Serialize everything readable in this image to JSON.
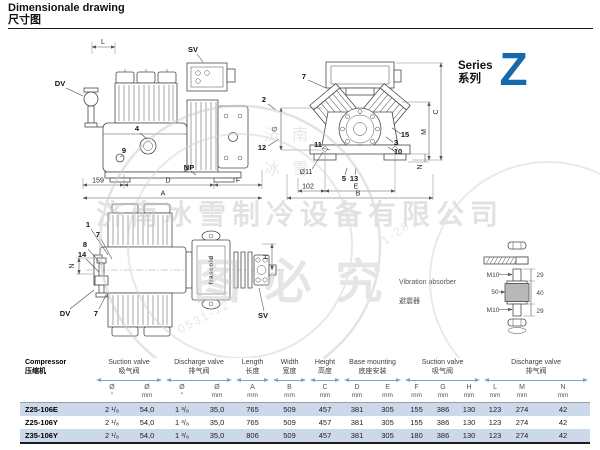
{
  "header": {
    "title_en": "Dimensionale drawing",
    "title_zh": "尺寸图"
  },
  "series": {
    "label_en": "Series",
    "label_zh": "系列",
    "letter": "Z",
    "color": "#1569ac"
  },
  "watermark": {
    "company": "济南冰雪制冷设备有限公司",
    "stamp": "图必究",
    "chars_1": "济",
    "chars_2": "南",
    "chars_3": "冰",
    "chars_4": "雪",
    "arc_left": "0531-12",
    "arc_right": "1-28"
  },
  "side_view": {
    "dim_l": "L",
    "sv": "SV",
    "dv": "DV",
    "c4": "4",
    "c9": "9",
    "np": "NP",
    "dim_159": "159",
    "dim_d": "D",
    "dim_f": "F",
    "dim_a": "A"
  },
  "front_view": {
    "c7": "7",
    "c2": "2",
    "c12": "12",
    "dim_g": "G",
    "c11": "11",
    "c15": "15",
    "c3": "3",
    "c10": "10",
    "c5": "5",
    "c13": "13",
    "dia11": "Ø11",
    "dim_102": "102",
    "dim_e": "E",
    "dim_b": "B",
    "dim_m": "M",
    "dim_c": "C",
    "dim_n": "N"
  },
  "top_view": {
    "c1": "1",
    "c7a": "7",
    "c8": "8",
    "c14": "14",
    "dim_n": "N",
    "dv": "DV",
    "c7b": "7",
    "sv": "SV",
    "dim_h": "H",
    "brand": "frascold"
  },
  "absorber": {
    "label_en": "Vibration absorber",
    "label_zh": "避震器",
    "m10_top": "M10",
    "m10_bot": "M10",
    "d50": "50",
    "d29_top": "29",
    "d40": "40",
    "d29_bot": "29"
  },
  "table": {
    "groups": [
      {
        "en": "Compressor",
        "zh": "压缩机"
      },
      {
        "en": "Suction valve",
        "zh": "吸气阀"
      },
      {
        "en": "Discharge valve",
        "zh": "排气阀"
      },
      {
        "en": "Length",
        "zh": "长度"
      },
      {
        "en": "Width",
        "zh": "宽度"
      },
      {
        "en": "Height",
        "zh": "高度"
      },
      {
        "en": "Base mounting",
        "zh": "底座安装"
      },
      {
        "en": "Suction valve",
        "zh": "吸气阀"
      },
      {
        "en": "Discharge valve",
        "zh": "排气阀"
      }
    ],
    "cols": [
      {
        "sym": "Ø",
        "unit": "″"
      },
      {
        "sym": "Ø",
        "unit": "mm"
      },
      {
        "sym": "Ø",
        "unit": "″"
      },
      {
        "sym": "Ø",
        "unit": "mm"
      },
      {
        "sym": "A",
        "unit": "mm"
      },
      {
        "sym": "B",
        "unit": "mm"
      },
      {
        "sym": "C",
        "unit": "mm"
      },
      {
        "sym": "D",
        "unit": "mm"
      },
      {
        "sym": "E",
        "unit": "mm"
      },
      {
        "sym": "F",
        "unit": "mm"
      },
      {
        "sym": "G",
        "unit": "mm"
      },
      {
        "sym": "H",
        "unit": "mm"
      },
      {
        "sym": "L",
        "unit": "mm"
      },
      {
        "sym": "M",
        "unit": "mm"
      },
      {
        "sym": "N",
        "unit": "mm"
      }
    ],
    "rows": [
      {
        "model": "Z25-106E",
        "values": [
          "2 ¹/₈",
          "54,0",
          "1 ³/₈",
          "35,0",
          "765",
          "509",
          "457",
          "381",
          "305",
          "155",
          "386",
          "130",
          "123",
          "274",
          "42"
        ]
      },
      {
        "model": "Z25-106Y",
        "values": [
          "2 ¹/₈",
          "54,0",
          "1 ³/₈",
          "35,0",
          "765",
          "509",
          "457",
          "381",
          "305",
          "155",
          "386",
          "130",
          "123",
          "274",
          "42"
        ]
      },
      {
        "model": "Z35-106Y",
        "values": [
          "2 ¹/₈",
          "54,0",
          "1 ³/₈",
          "35,0",
          "806",
          "509",
          "457",
          "381",
          "305",
          "180",
          "386",
          "130",
          "123",
          "274",
          "42"
        ]
      }
    ]
  }
}
